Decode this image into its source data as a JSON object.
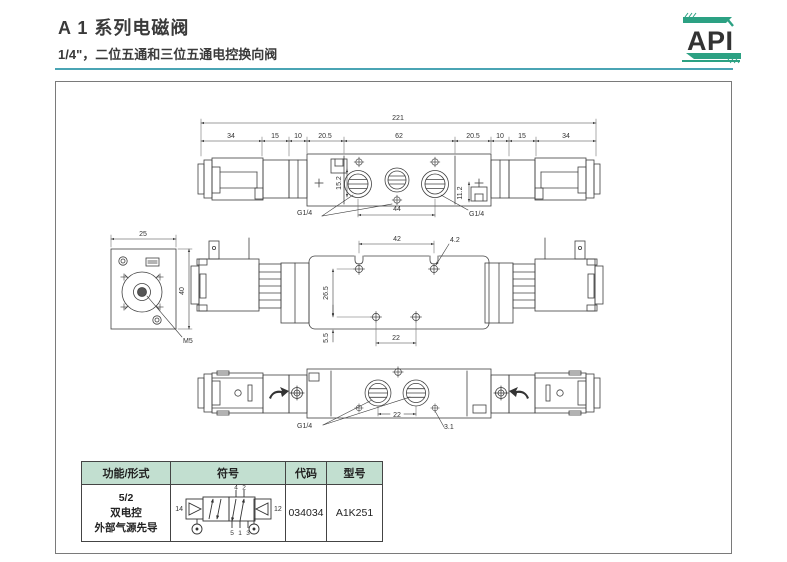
{
  "header": {
    "title": "A 1 系列电磁阀",
    "subtitle": "1/4\"，二位五通和三位五通电控换向阀",
    "logo_text": "API"
  },
  "colors": {
    "accent_teal": "#4aa4b4",
    "brand_green": "#2ca183",
    "table_header_bg": "#c2dfd0",
    "line_gray": "#404040"
  },
  "drawing": {
    "top_view": {
      "total": "221",
      "chain": [
        "34",
        "15",
        "10",
        "20.5",
        "62",
        "20.5",
        "10",
        "15",
        "34"
      ],
      "dim_a": "15.2",
      "dim_b": "11.2",
      "dim_c": "44",
      "port_left": "G1/4",
      "port_right": "G1/4"
    },
    "end_view": {
      "width": "25",
      "height": "40",
      "thread": "M5"
    },
    "side_view": {
      "hole_span": "42",
      "hole_dia": "4.2",
      "height_dim": "26.5",
      "base_dim": "5.5",
      "bottom_span": "22"
    },
    "bottom_view": {
      "port": "G1/4",
      "span": "22",
      "pilot_dia": "3.1"
    }
  },
  "table": {
    "headers": [
      "功能/形式",
      "符号",
      "代码",
      "型号"
    ],
    "row": {
      "function": [
        "5/2",
        "双电控",
        "外部气源先导"
      ],
      "code": "034034",
      "model": "A1K251",
      "symbol": {
        "pilot_left": "14",
        "pilot_right": "12",
        "ports_top": [
          "4",
          "2"
        ],
        "ports_bottom": [
          "5",
          "1",
          "3"
        ]
      }
    }
  }
}
